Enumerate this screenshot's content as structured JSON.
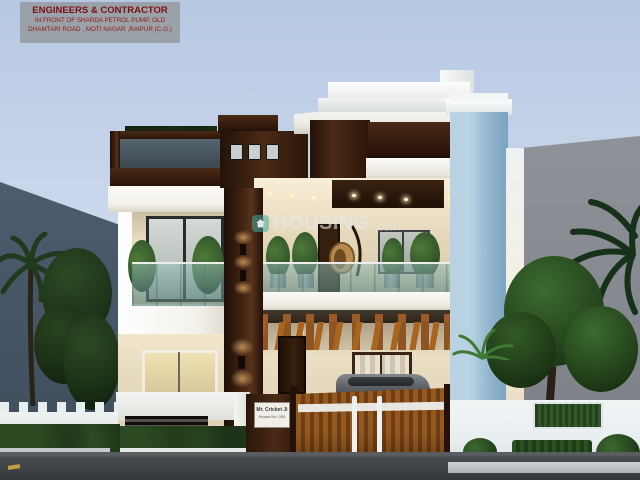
{
  "header": {
    "line1": "ENGINEERS & CONTRACTOR",
    "line2": "IN FRONT OF SHARDA PETROL PUMP, OLD",
    "line3": "DHAMTARI ROAD , MOTI NAGAR ,RAIPUR (C.G.)"
  },
  "watermark": {
    "brand": "HOUSING",
    "suffix": ".com"
  },
  "nameplate": {
    "line1": "Mr. Cricket Ji",
    "line2": "House No. 000"
  },
  "colors": {
    "sky_top": "#b7c8e2",
    "sky_mid": "#cfdbee",
    "sky_bottom": "#e2eaf5",
    "badge_bg": "#9ba1a9",
    "badge_text": "#7a1015",
    "bldg_left": "#4d5d6e",
    "bldg_right": "#8f9399",
    "cream": "#e9dfc8",
    "cream_lit": "#f9efd6",
    "slab": "#f3f1ea",
    "wood_dark": "#2f1a10",
    "gate_wood": "#8a5526",
    "pergola": "#9a5b28",
    "blue_light": "#b9d2e2",
    "blue_dark": "#7ba3bf",
    "road": "#3f4347",
    "wall_white": "#e9eef0"
  }
}
